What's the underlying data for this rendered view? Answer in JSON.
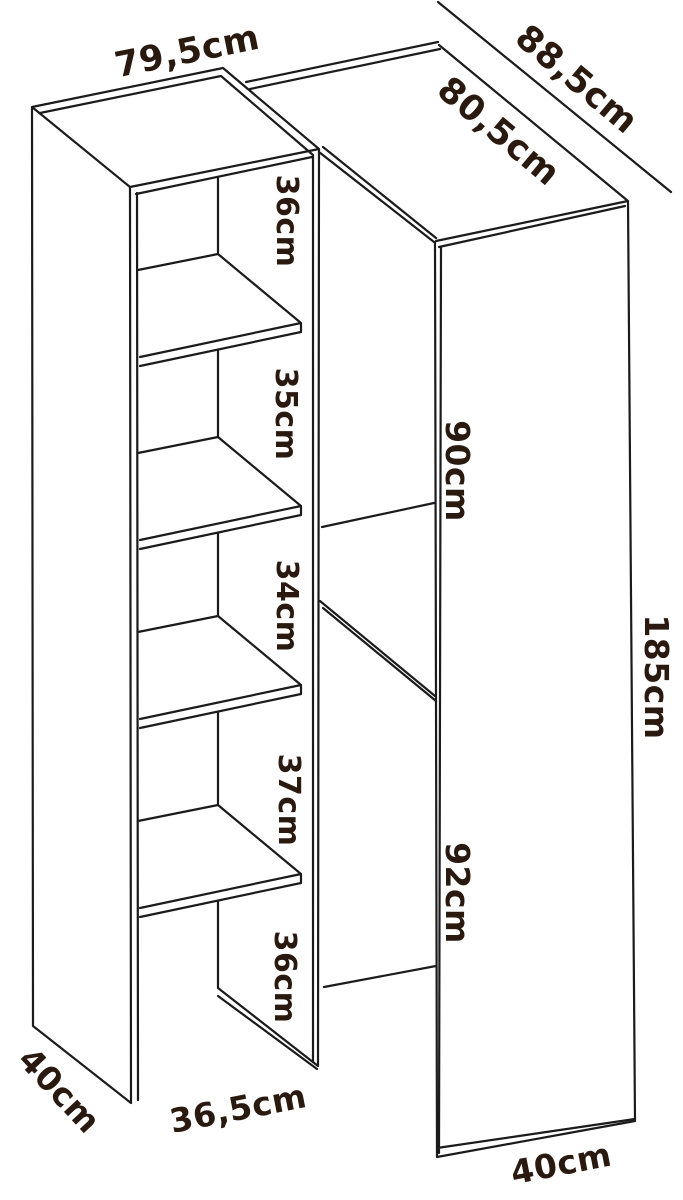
{
  "diagram": {
    "description": "Corner wardrobe with open shelf column - dimension drawing",
    "colors": {
      "line": "#1b1b1b",
      "label": "#2a190f",
      "background": "#ffffff"
    },
    "left_unit": {
      "top_width": "79,5cm",
      "side_depth": "40cm",
      "front_width": "36,5cm",
      "compartments": [
        "36cm",
        "35cm",
        "34cm",
        "37cm",
        "36cm"
      ]
    },
    "cabinet": {
      "diagonal_width": "88,5cm",
      "top_depth": "80,5cm",
      "upper_section_height": "90cm",
      "lower_section_height": "92cm",
      "total_height": "185cm",
      "bottom_depth": "40cm"
    }
  }
}
